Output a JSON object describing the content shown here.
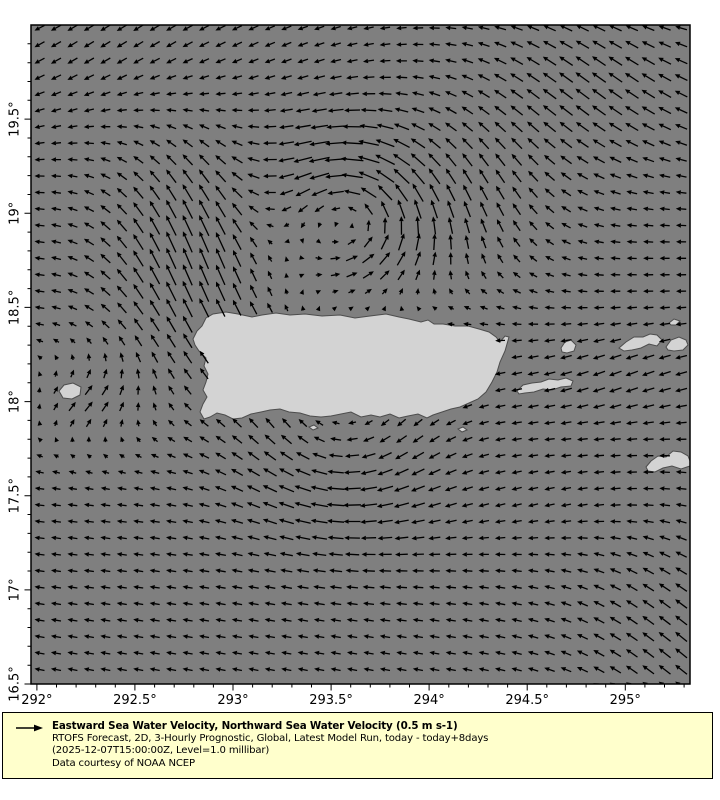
{
  "figure": {
    "width": 720,
    "height": 800,
    "background": "#ffffff"
  },
  "map": {
    "plot_rect": {
      "x": 31,
      "y": 25,
      "width": 659,
      "height": 659
    },
    "lon_range": [
      291.97,
      295.33
    ],
    "lat_range": [
      16.5,
      20.0
    ],
    "colors": {
      "ocean": "#7f7f7f",
      "land": "#d3d3d3",
      "coastline": "#4d4d4d",
      "frame": "#000000",
      "arrow": "#000000",
      "tick": "#000000"
    },
    "islands": [
      {
        "name": "puerto-rico",
        "points": [
          [
            193,
            339
          ],
          [
            197,
            331
          ],
          [
            202,
            326
          ],
          [
            206,
            318
          ],
          [
            213,
            314
          ],
          [
            226,
            312
          ],
          [
            238,
            314
          ],
          [
            252,
            317
          ],
          [
            262,
            315
          ],
          [
            276,
            313
          ],
          [
            290,
            315
          ],
          [
            305,
            314
          ],
          [
            322,
            316
          ],
          [
            340,
            315
          ],
          [
            355,
            318
          ],
          [
            370,
            316
          ],
          [
            386,
            314
          ],
          [
            399,
            317
          ],
          [
            409,
            319
          ],
          [
            421,
            322
          ],
          [
            428,
            320
          ],
          [
            434,
            324
          ],
          [
            443,
            324
          ],
          [
            455,
            326
          ],
          [
            468,
            326
          ],
          [
            479,
            329
          ],
          [
            489,
            332
          ],
          [
            496,
            337
          ],
          [
            500,
            342
          ],
          [
            505,
            336
          ],
          [
            509,
            337
          ],
          [
            505,
            351
          ],
          [
            500,
            362
          ],
          [
            497,
            372
          ],
          [
            492,
            382
          ],
          [
            486,
            392
          ],
          [
            478,
            399
          ],
          [
            469,
            403
          ],
          [
            460,
            407
          ],
          [
            451,
            409
          ],
          [
            442,
            412
          ],
          [
            433,
            415
          ],
          [
            427,
            418
          ],
          [
            418,
            414
          ],
          [
            408,
            416
          ],
          [
            399,
            418
          ],
          [
            390,
            414
          ],
          [
            380,
            417
          ],
          [
            371,
            415
          ],
          [
            361,
            417
          ],
          [
            351,
            412
          ],
          [
            341,
            414
          ],
          [
            331,
            416
          ],
          [
            321,
            417
          ],
          [
            310,
            416
          ],
          [
            300,
            413
          ],
          [
            289,
            412
          ],
          [
            280,
            409
          ],
          [
            270,
            410
          ],
          [
            261,
            412
          ],
          [
            251,
            414
          ],
          [
            242,
            418
          ],
          [
            233,
            419
          ],
          [
            225,
            415
          ],
          [
            217,
            413
          ],
          [
            210,
            417
          ],
          [
            204,
            419
          ],
          [
            200,
            412
          ],
          [
            203,
            404
          ],
          [
            207,
            397
          ],
          [
            203,
            390
          ],
          [
            206,
            382
          ],
          [
            208,
            374
          ],
          [
            204,
            366
          ],
          [
            206,
            358
          ],
          [
            199,
            351
          ],
          [
            195,
            345
          ]
        ]
      },
      {
        "name": "mona",
        "points": [
          [
            59,
            391
          ],
          [
            64,
            385
          ],
          [
            73,
            383
          ],
          [
            81,
            387
          ],
          [
            80,
            395
          ],
          [
            72,
            399
          ],
          [
            63,
            398
          ]
        ]
      },
      {
        "name": "vieques",
        "points": [
          [
            517,
            391
          ],
          [
            523,
            385
          ],
          [
            532,
            383
          ],
          [
            541,
            382
          ],
          [
            549,
            379
          ],
          [
            558,
            380
          ],
          [
            566,
            378
          ],
          [
            573,
            381
          ],
          [
            571,
            386
          ],
          [
            561,
            387
          ],
          [
            552,
            390
          ],
          [
            543,
            389
          ],
          [
            534,
            392
          ],
          [
            525,
            393
          ],
          [
            519,
            394
          ]
        ]
      },
      {
        "name": "culebra",
        "points": [
          [
            561,
            348
          ],
          [
            565,
            342
          ],
          [
            571,
            340
          ],
          [
            576,
            345
          ],
          [
            574,
            351
          ],
          [
            567,
            353
          ],
          [
            562,
            352
          ]
        ]
      },
      {
        "name": "st-thomas",
        "points": [
          [
            619,
            348
          ],
          [
            626,
            342
          ],
          [
            634,
            337
          ],
          [
            643,
            337
          ],
          [
            650,
            334
          ],
          [
            657,
            335
          ],
          [
            662,
            340
          ],
          [
            657,
            346
          ],
          [
            649,
            344
          ],
          [
            641,
            348
          ],
          [
            632,
            350
          ],
          [
            624,
            351
          ]
        ]
      },
      {
        "name": "tortola",
        "points": [
          [
            666,
            347
          ],
          [
            671,
            340
          ],
          [
            679,
            337
          ],
          [
            686,
            340
          ],
          [
            688,
            345
          ],
          [
            683,
            350
          ],
          [
            674,
            351
          ],
          [
            668,
            350
          ]
        ]
      },
      {
        "name": "islet-northeast",
        "points": [
          [
            669,
            323
          ],
          [
            674,
            319
          ],
          [
            680,
            321
          ],
          [
            676,
            325
          ],
          [
            671,
            325
          ]
        ]
      },
      {
        "name": "st-croix",
        "points": [
          [
            646,
            467
          ],
          [
            651,
            461
          ],
          [
            658,
            456
          ],
          [
            666,
            457
          ],
          [
            673,
            451
          ],
          [
            681,
            452
          ],
          [
            688,
            456
          ],
          [
            690,
            461
          ],
          [
            690,
            466
          ],
          [
            681,
            469
          ],
          [
            672,
            466
          ],
          [
            663,
            468
          ],
          [
            655,
            472
          ],
          [
            648,
            471
          ]
        ]
      },
      {
        "name": "islet-south-1",
        "points": [
          [
            309,
            427
          ],
          [
            314,
            425
          ],
          [
            318,
            428
          ],
          [
            313,
            430
          ]
        ]
      },
      {
        "name": "islet-south-2",
        "points": [
          [
            458,
            429
          ],
          [
            463,
            427
          ],
          [
            467,
            430
          ],
          [
            462,
            432
          ]
        ]
      }
    ]
  },
  "chart_data": {
    "type": "quiver",
    "variable": "Eastward Sea Water Velocity, Northward Sea Water Velocity",
    "reference_vector": {
      "label": "0.5 m s-1",
      "value_m_s": 0.5
    },
    "x_axis": {
      "major_ticks": [
        292,
        292.5,
        293,
        293.5,
        294,
        294.5,
        295
      ],
      "major_tick_labels": [
        "292°",
        "292.5°",
        "293°",
        "293.5°",
        "294°",
        "294.5°",
        "295°"
      ],
      "minor_ticks": [
        292.1,
        292.2,
        292.3,
        292.4,
        292.6,
        292.7,
        292.8,
        292.9,
        293.1,
        293.2,
        293.3,
        293.4,
        293.6,
        293.7,
        293.8,
        293.9,
        294.1,
        294.2,
        294.3,
        294.4,
        294.6,
        294.7,
        294.8,
        294.9,
        295.1,
        295.2,
        295.3
      ]
    },
    "y_axis": {
      "major_ticks": [
        16.5,
        17,
        17.5,
        18,
        18.5,
        19,
        19.5
      ],
      "major_tick_labels": [
        "16.5°",
        "17°",
        "17.5°",
        "18°",
        "18.5°",
        "19°",
        "19.5°"
      ],
      "minor_ticks": [
        16.6,
        16.7,
        16.8,
        16.9,
        17.1,
        17.2,
        17.3,
        17.4,
        17.6,
        17.7,
        17.8,
        17.9,
        18.1,
        18.2,
        18.3,
        18.4,
        18.6,
        18.7,
        18.8,
        18.9,
        19.1,
        19.2,
        19.3,
        19.4,
        19.6,
        19.7,
        19.8,
        19.9
      ]
    },
    "grid": {
      "x0": 39.5,
      "y0": 28,
      "dx": 16.45,
      "dy": 16.45,
      "cols": 40,
      "rows": 41
    },
    "arrow_style": {
      "scale": 10,
      "min_len": 4,
      "max_len": 23,
      "head_len": 5,
      "head_half_width": 2.3,
      "line_width": 1.3
    },
    "flow_model": {
      "base": {
        "u": -1.0,
        "v_coeff": 0.0005,
        "v_ref_y": 300
      },
      "features": [
        {
          "type": "vortex",
          "sense": "ccw",
          "cx": 348,
          "cy": 212,
          "k": 0.042,
          "sigma": 72,
          "note": "cyclonic eddy north of Puerto Rico"
        },
        {
          "type": "gauss",
          "cx": 480,
          "cy": 205,
          "sx": 85,
          "sy": 85,
          "du": 0.25,
          "dv": -1.25,
          "note": "northward limb east of eddy"
        },
        {
          "type": "gauss",
          "cx": 392,
          "cy": 258,
          "sx": 95,
          "sy": 45,
          "du": 0.95,
          "dv": -0.2,
          "note": "eastward return flow south of eddy"
        },
        {
          "type": "gauss",
          "cx": 196,
          "cy": 252,
          "sx": 95,
          "sy": 118,
          "du": 0,
          "dv": -2.35,
          "note": "northward jet west of Puerto Rico"
        },
        {
          "type": "gauss",
          "cx": 590,
          "cy": 85,
          "sx": 140,
          "sy": 92,
          "du": -0.4,
          "dv": -1.1,
          "note": "northwestward flow top right"
        },
        {
          "type": "gauss",
          "cx": 140,
          "cy": 52,
          "sx": 200,
          "sy": 80,
          "du": 0,
          "dv": 0.55,
          "note": "southwestward tilt top left"
        },
        {
          "type": "vortex",
          "sense": "cw",
          "cx": 340,
          "cy": 434,
          "k": 0.02,
          "sigma": 92,
          "note": "eddy south of Puerto Rico"
        },
        {
          "type": "gauss",
          "cx": 88,
          "cy": 400,
          "sx": 70,
          "sy": 52,
          "du": 1.8,
          "dv": -0.8,
          "note": "northeastward flow in Mona Passage"
        },
        {
          "type": "gauss",
          "cx": 622,
          "cy": 378,
          "sx": 115,
          "sy": 55,
          "du": -0.25,
          "dv": 0.5,
          "note": "southwestward flow south of Virgin Islands"
        },
        {
          "type": "gauss",
          "cx": 688,
          "cy": 640,
          "sx": 115,
          "sy": 135,
          "du": -0.2,
          "dv": -0.8,
          "note": "northwestward flow bottom right corner"
        },
        {
          "type": "gauss",
          "cx": 575,
          "cy": 505,
          "sx": 135,
          "sy": 55,
          "du": 0,
          "dv": 0.38,
          "note": "slight southwest tilt east central"
        }
      ]
    }
  },
  "legend": {
    "bg": "#ffffcc",
    "border": "#000000",
    "arrow_icon": "right-arrow",
    "title": "Eastward Sea Water Velocity, Northward Sea Water Velocity (0.5 m s-1)",
    "line2": "RTOFS Forecast, 2D, 3-Hourly Prognostic, Global, Latest Model Run, today - today+8days",
    "line3": "(2025-12-07T15:00:00Z, Level=1.0 millibar)",
    "line4": "Data courtesy of NOAA NCEP"
  }
}
